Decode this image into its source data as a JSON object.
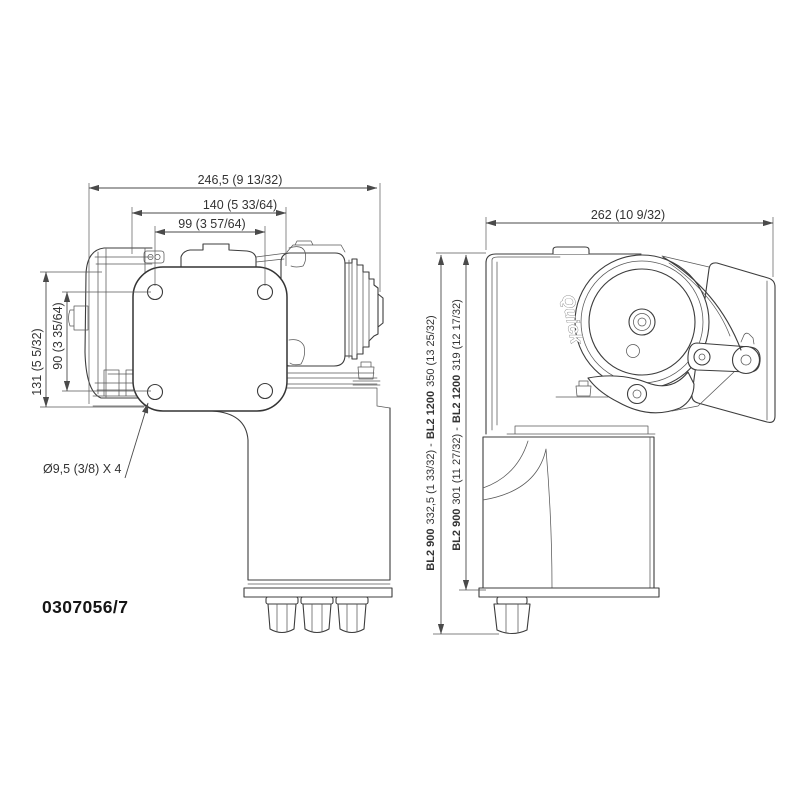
{
  "front_view": {
    "dim_overall_width": "246,5 (9 13/32)",
    "dim_flange_width": "140 (5 33/64)",
    "dim_bolt_spacing_horizontal": "99 (3 57/64)",
    "dim_overall_height": "131 (5 5/32)",
    "dim_bolt_spacing_vertical": "90 (3 35/64)",
    "mounting_holes_note": "Ø9,5 (3/8) X 4"
  },
  "side_view": {
    "dim_overall_width": "262 (10 9/32)",
    "dim_total_height": {
      "model_a": "BL2 900",
      "value_a": "332,5 (1 33/32) -",
      "model_b": "BL2 1200",
      "value_b": "350 (13 25/32)"
    },
    "dim_base_height": {
      "model_a": "BL2 900",
      "value_a": "301 (11 27/32) -",
      "model_b": "BL2 1200",
      "value_b": "319 (12 17/32)"
    },
    "brand_logo": "Quick"
  },
  "drawing_code": "0307056/7",
  "colors": {
    "line": "#3d3d3d",
    "dimension": "#4a4a4a",
    "background": "#ffffff"
  }
}
